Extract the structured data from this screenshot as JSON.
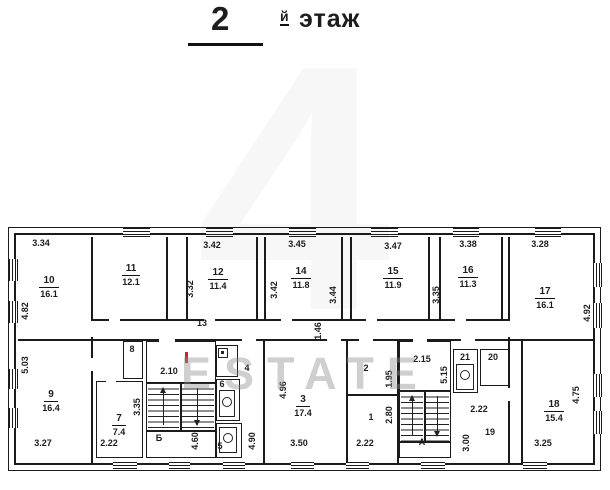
{
  "title": {
    "number": "2",
    "suffix": "й",
    "word": "этаж"
  },
  "watermark": {
    "numeral": "4",
    "brand": "ESTATE"
  },
  "corridor": {
    "number": "13",
    "dim_width": "1.46"
  },
  "rooms": {
    "r10": {
      "number": "10",
      "area": "16.1",
      "dim_top": "3.34",
      "dim_left": "4.82"
    },
    "r11": {
      "number": "11",
      "area": "12.1"
    },
    "r12": {
      "number": "12",
      "area": "11.4",
      "dim_top": "3.42",
      "dim_left": "3.32"
    },
    "r14": {
      "number": "14",
      "area": "11.8",
      "dim_top": "3.45",
      "dim_left": "3.42"
    },
    "r15": {
      "number": "15",
      "area": "11.9",
      "dim_top": "3.47",
      "dim_left": "3.44"
    },
    "r16": {
      "number": "16",
      "area": "11.3",
      "dim_top": "3.38",
      "dim_left": "3.35"
    },
    "r17": {
      "number": "17",
      "area": "16.1",
      "dim_top": "3.28",
      "dim_right": "4.92"
    },
    "r9": {
      "number": "9",
      "area": "16.4",
      "dim_left": "5.03",
      "dim_bottom": "3.27"
    },
    "r7": {
      "number": "7",
      "area": "7.4",
      "dim_right": "3.35",
      "dim_bottom": "2.22"
    },
    "r8": {
      "number": "8"
    },
    "r6": {
      "number": "6"
    },
    "r5": {
      "number": "5"
    },
    "r4": {
      "number": "4",
      "dim_right": "4.90"
    },
    "r3": {
      "number": "3",
      "area": "17.4",
      "dim_left": "4.96",
      "dim_bottom": "3.50"
    },
    "r2": {
      "number": "2",
      "dim_right": "1.95"
    },
    "r1": {
      "number": "1",
      "dim_right": "2.80",
      "dim_bottom": "2.22"
    },
    "r21": {
      "number": "21"
    },
    "r20": {
      "number": "20"
    },
    "r19": {
      "number": "19",
      "dim_top": "2.22",
      "dim_left": "3.00"
    },
    "r18": {
      "number": "18",
      "area": "15.4",
      "dim_right": "4.75",
      "dim_bottom": "3.25"
    }
  },
  "stairwells": {
    "B": {
      "label": "Б",
      "dim_top": "2.10",
      "dim_right": "4.60"
    },
    "A": {
      "label": "А",
      "dim_top": "2.15",
      "dim_left": "5.15"
    }
  }
}
